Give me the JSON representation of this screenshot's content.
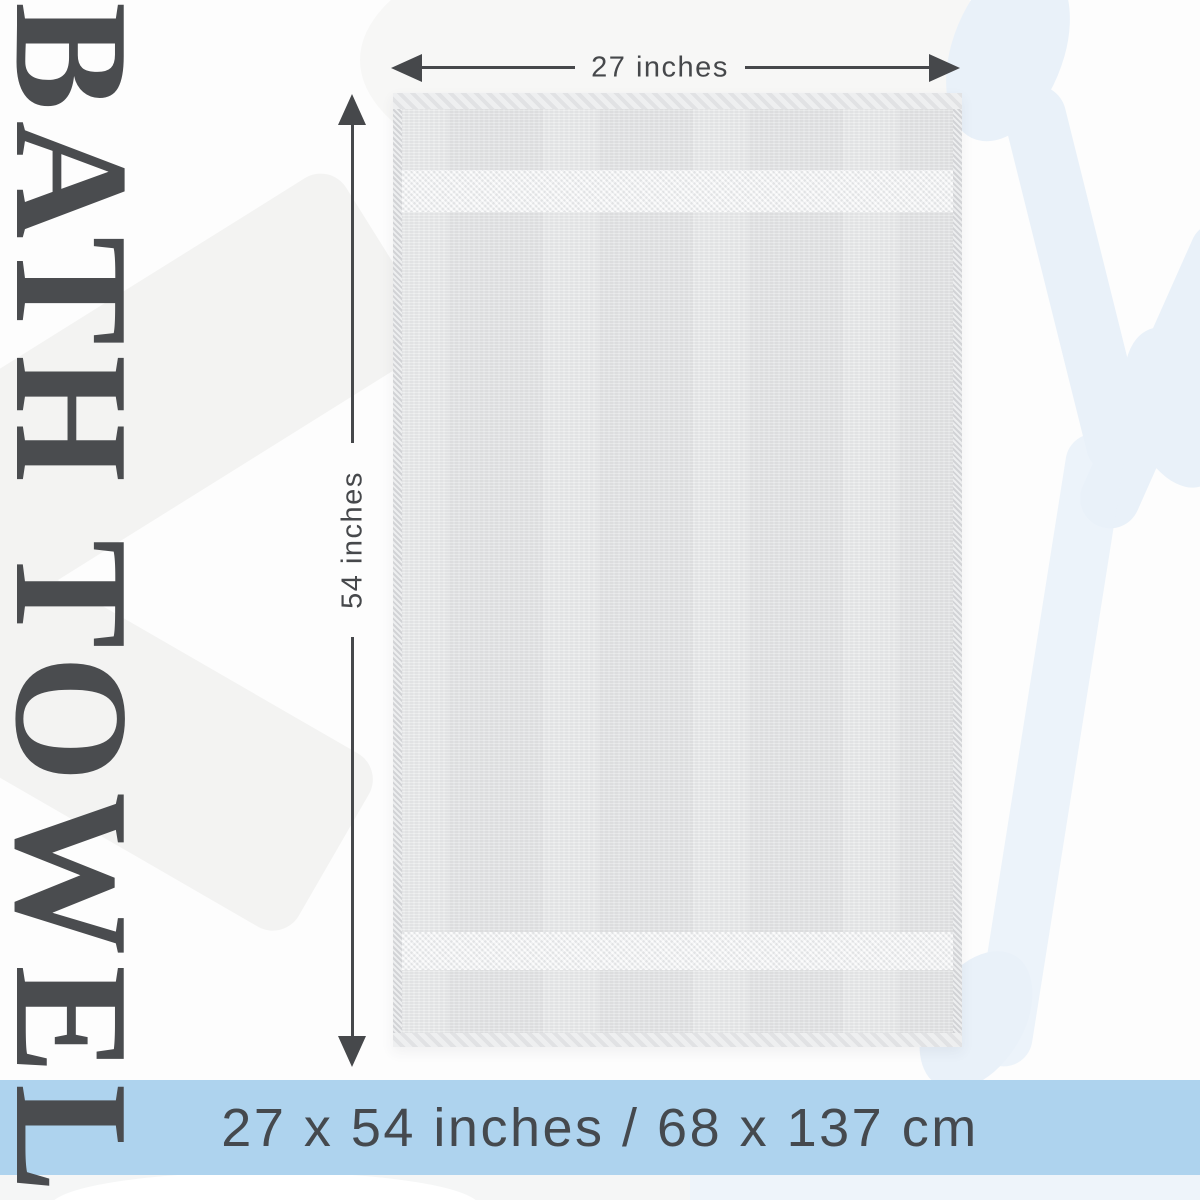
{
  "title": "BATH TOWEL",
  "dimensions": {
    "width_label": "27 inches",
    "height_label": "54 inches"
  },
  "banner": {
    "label": "27 x 54 inches / 68 x 137 cm"
  },
  "colors": {
    "ink": "#46484b",
    "banner-bg": "#aed3ee",
    "banner-text": "#45494e",
    "towel-base": "#e7e8e9",
    "towel-band": "#f1f2f3",
    "towel-edge": "#dfe0e2",
    "bg": "#fdfdfd",
    "shape-blue": "#e9f1f9",
    "shape-gray": "#f3f3f2"
  }
}
